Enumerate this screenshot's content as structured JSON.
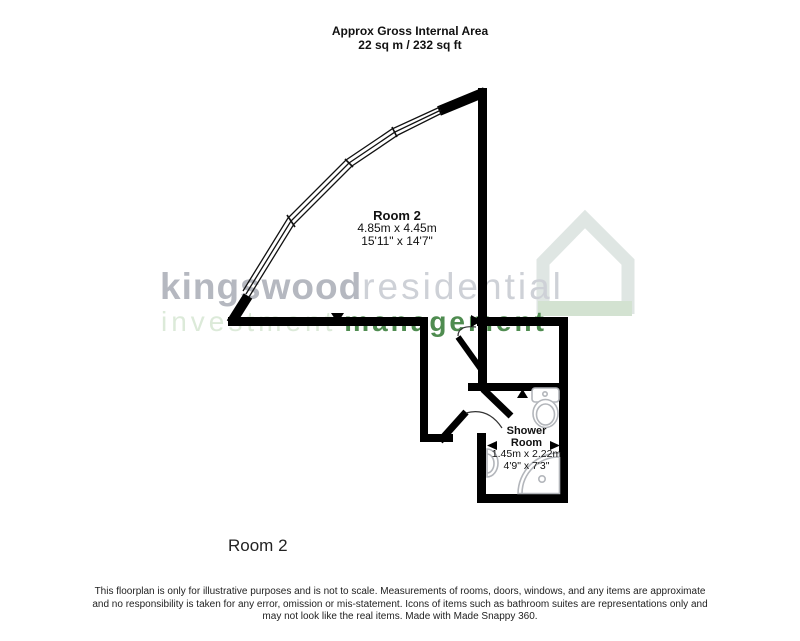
{
  "header": {
    "line1": "Approx Gross Internal Area",
    "line2": "22 sq m / 232 sq ft"
  },
  "watermark": {
    "brand_bold": "kingswood",
    "brand_light": "residential",
    "tagline_light": "investment",
    "tagline_bold": "management"
  },
  "plan": {
    "room2": {
      "name": "Room 2",
      "metric": "4.85m x 4.45m",
      "imperial": "15'11\" x 14'7\""
    },
    "shower_room": {
      "name_line1": "Shower",
      "name_line2": "Room",
      "metric": "1.45m x 2.22m",
      "imperial": "4'9\" x 7'3\""
    },
    "fixtures": [
      "toilet",
      "sink",
      "corner-shower"
    ]
  },
  "floor_label": "Room 2",
  "disclaimer": {
    "line1": "This floorplan is only for illustrative purposes and is not to scale. Measurements of rooms, doors, windows, and any items are approximate",
    "line2": "and no responsibility is taken for any error, omission or mis-statement. Icons of items such as bathroom suites are representations only and",
    "line3": "may not look like the real items. Made with Made Snappy 360."
  },
  "colors": {
    "wall": "#000000",
    "fixture_outline": "#b3b6bb",
    "brand_gray_bold": "#b5b8c0",
    "brand_gray_light": "#ced1d7",
    "tagline_green_light": "#dcead9",
    "tagline_green_bold": "#4f8c50",
    "house_icon": "#dfe6e3",
    "house_icon_base": "#d3e2d1"
  }
}
